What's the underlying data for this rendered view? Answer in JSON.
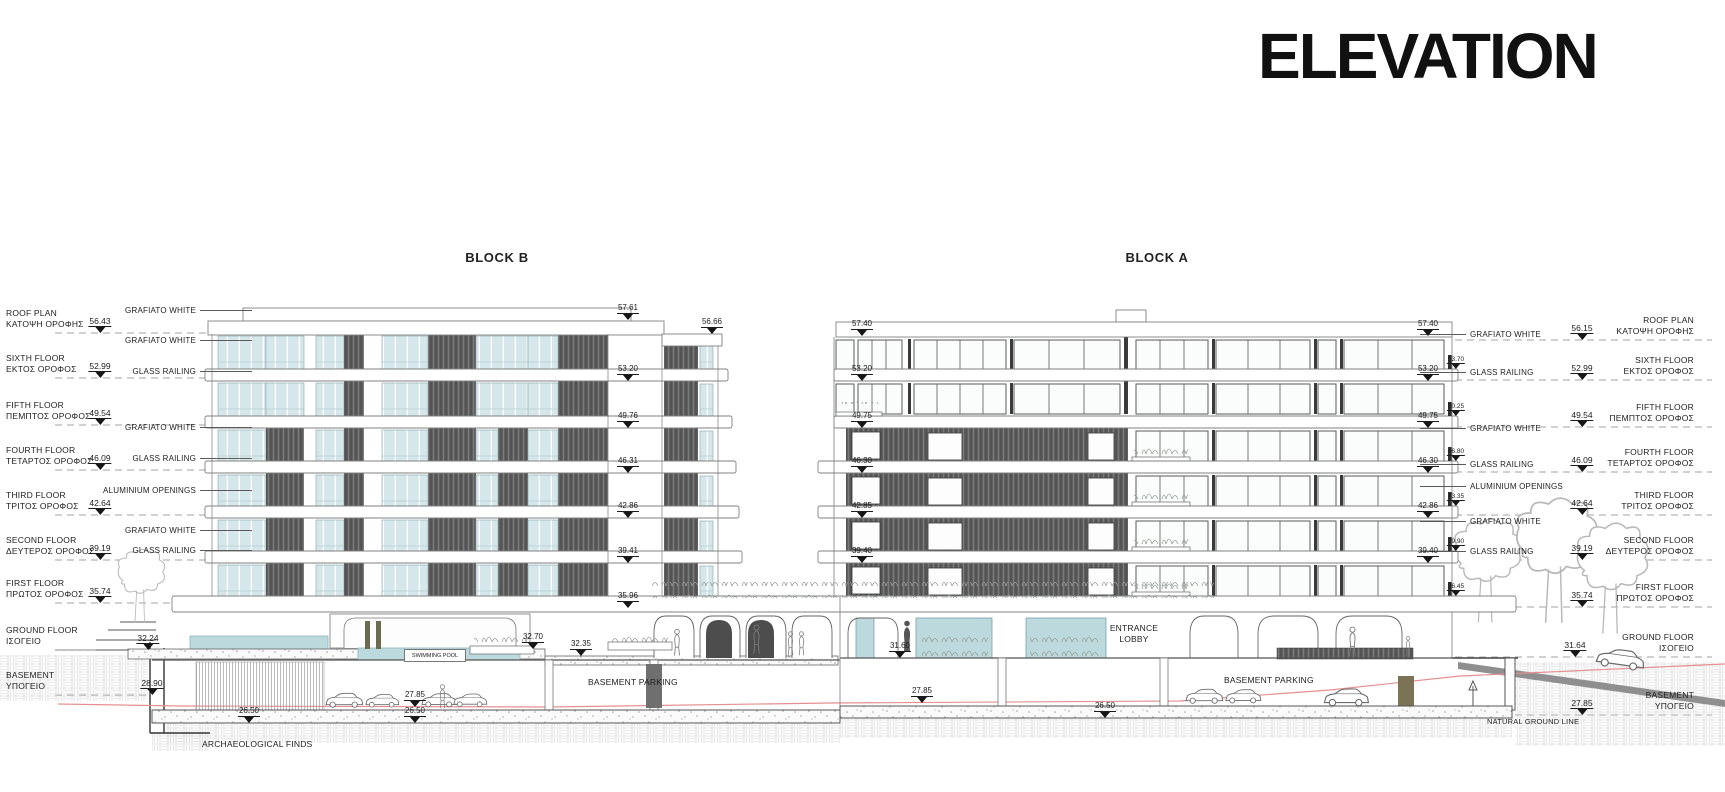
{
  "title": "ELEVATION",
  "block_b_label": "BLOCK B",
  "block_a_label": "BLOCK A",
  "left_levels": [
    {
      "name": "ROOF PLAN",
      "greek": "ΚΑΤΟΨΗ ΟΡΟΦΗΣ",
      "elev": "56.43"
    },
    {
      "name": "SIXTH FLOOR",
      "greek": "ΕΚΤΟΣ ΟΡΟΦΟΣ",
      "elev": "52.99"
    },
    {
      "name": "FIFTH FLOOR",
      "greek": "ΠΕΜΠΤΟΣ ΟΡΟΦΟΣ",
      "elev": "49.54"
    },
    {
      "name": "FOURTH FLOOR",
      "greek": "ΤΕΤΑΡΤΟΣ ΟΡΟΦΟΣ",
      "elev": "46.09"
    },
    {
      "name": "THIRD FLOOR",
      "greek": "ΤΡΙΤΟΣ ΟΡΟΦΟΣ",
      "elev": "42.64"
    },
    {
      "name": "SECOND FLOOR",
      "greek": "ΔΕΥΤΕΡΟΣ ΟΡΟΦΟΣ",
      "elev": "39.19"
    },
    {
      "name": "FIRST FLOOR",
      "greek": "ΠΡΩΤΟΣ ΟΡΟΦΟΣ",
      "elev": "35.74"
    },
    {
      "name": "GROUND FLOOR",
      "greek": "ΙΣΟΓΕΙΟ",
      "elev": "32.24"
    },
    {
      "name": "BASEMENT",
      "greek": "ΥΠΟΓΕΙΟ",
      "elev": "28.90"
    }
  ],
  "right_levels": [
    {
      "name": "ROOF PLAN",
      "greek": "ΚΑΤΟΨΗ ΟΡΟΦΗΣ",
      "elev": "56.15"
    },
    {
      "name": "SIXTH FLOOR",
      "greek": "ΕΚΤΟΣ ΟΡΟΦΟΣ",
      "elev": "52.99"
    },
    {
      "name": "FIFTH FLOOR",
      "greek": "ΠΕΜΠΤΟΣ ΟΡΟΦΟΣ",
      "elev": "49.54"
    },
    {
      "name": "FOURTH FLOOR",
      "greek": "ΤΕΤΑΡΤΟΣ ΟΡΟΦΟΣ",
      "elev": "46.09"
    },
    {
      "name": "THIRD FLOOR",
      "greek": "ΤΡΙΤΟΣ ΟΡΟΦΟΣ",
      "elev": "42.64"
    },
    {
      "name": "SECOND FLOOR",
      "greek": "ΔΕΥΤΕΡΟΣ ΟΡΟΦΟΣ",
      "elev": "39.19"
    },
    {
      "name": "FIRST FLOOR",
      "greek": "ΠΡΩΤΟΣ ΟΡΟΦΟΣ",
      "elev": "35.74"
    },
    {
      "name": "GROUND FLOOR",
      "greek": "ΙΣΟΓΕΙΟ",
      "elev": "31.64"
    },
    {
      "name": "BASEMENT",
      "greek": "ΥΠΟΓΕΙΟ",
      "elev": "27.85"
    }
  ],
  "left_materials": [
    "GRAFIATO WHITE",
    "GRAFIATO WHITE",
    "GLASS RAILING",
    "GRAFIATO WHITE",
    "GLASS RAILING",
    "ALUMINIUM  OPENINGS",
    "GRAFIATO WHITE",
    "GLASS RAILING"
  ],
  "right_materials": [
    "GRAFIATO WHITE",
    "GLASS RAILING",
    "GRAFIATO WHITE",
    "GLASS RAILING",
    "ALUMINIUM  OPENINGS",
    "GRAFIATO WHITE",
    "GLASS RAILING"
  ],
  "block_b_markers": {
    "roof": "57.61",
    "parapet": "56.66",
    "floors": [
      "53.20",
      "49.76",
      "46.31",
      "42.86",
      "39.41",
      "35.96"
    ]
  },
  "block_a_markers": {
    "roof_left": "57.40",
    "roof_right": "57.40",
    "floors_left": [
      "53.20",
      "49.75",
      "46.30",
      "42.85",
      "39.40"
    ],
    "floors_right": [
      "53.20",
      "49.75",
      "46.30",
      "42.86",
      "39.40"
    ],
    "railings": [
      "53.70",
      "50.25",
      "46.80",
      "43.35",
      "39.90",
      "36.45"
    ]
  },
  "ground_markers": {
    "deck": "32.70",
    "court": "32.35",
    "lobby": "31.60"
  },
  "basement_markers": {
    "b_ground": "27.85",
    "b_slab_left": "26.50",
    "b_slab_mid": "26.50",
    "a_ground": "27.85",
    "a_slab": "26.50"
  },
  "annotations": {
    "swimming_pool": "SWIMMING POOL",
    "basement_parking_b": "BASEMENT PARKING",
    "basement_parking_a": "BASEMENT PARKING",
    "entrance_lobby": "ENTRANCE LOBBY",
    "archaeological_finds": "ARCHAEOLOGICAL FINDS",
    "natural_ground_line": "NATURAL GROUND LINE"
  },
  "colors": {
    "glass_teal": "#cde3e7",
    "louver_dark": "#616161",
    "ground_line_red": "#e59090",
    "dash_gray": "#a3a3a3",
    "ink": "#1a1a1a"
  }
}
